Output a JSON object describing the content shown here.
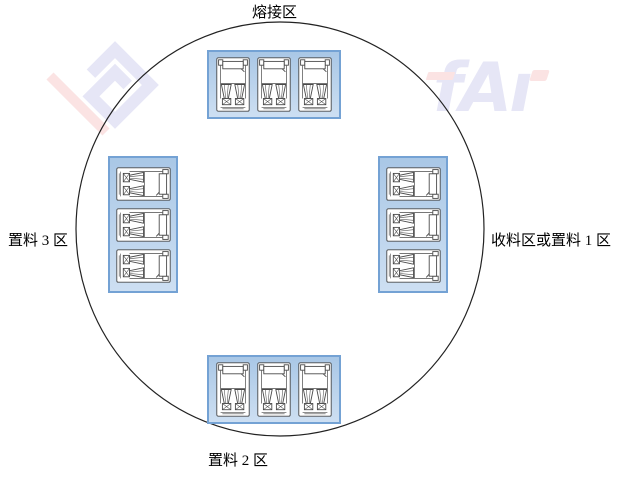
{
  "diagram": {
    "type": "rotary-turntable-layout",
    "background": "#ffffff"
  },
  "zones": [
    {
      "id": "welding",
      "label": "熔接区",
      "position": "top",
      "module_count": 3,
      "module_orientation": "portrait"
    },
    {
      "id": "receive-or-load-1",
      "label": "收料区或置料 1 区",
      "position": "right",
      "module_count": 3,
      "module_orientation": "landscape"
    },
    {
      "id": "load-2",
      "label": "置料 2 区",
      "position": "bottom",
      "module_count": 3,
      "module_orientation": "portrait"
    },
    {
      "id": "load-3",
      "label": "置料 3 区",
      "position": "left",
      "module_count": 3,
      "module_orientation": "landscape"
    }
  ],
  "watermark": {
    "text": "fAı"
  },
  "colors": {
    "circle_stroke": "#222222",
    "container_border": "#74a2d4",
    "container_fill_top": "#a9c7e6",
    "container_fill_bottom": "#cddff2",
    "module_line": "#4a4a4a",
    "module_fill": "#ffffff",
    "label_color": "#000000",
    "watermark_lavender": "#e6e6f6",
    "watermark_pink": "#fbe3e3"
  }
}
